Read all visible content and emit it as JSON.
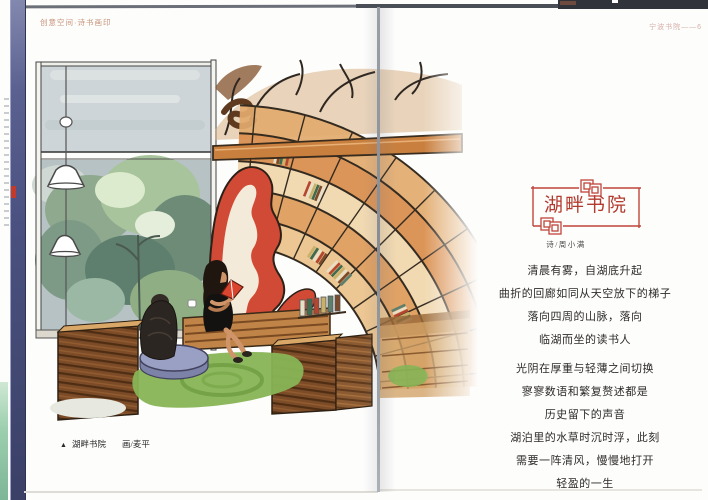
{
  "book": {
    "header_left": "创意空间·诗书画印",
    "header_right": "宁波书院——6"
  },
  "left_page": {
    "caption": {
      "marker": "▲",
      "title": "湖畔书院",
      "credit": "画/麦平"
    }
  },
  "right_page": {
    "title": "湖畔书院",
    "byline": "诗/周小满",
    "poem": {
      "stanza_1": [
        "清晨有雾，自湖底升起",
        "曲折的回廊如同从天空放下的梯子",
        "落向四周的山脉，落向",
        "临湖而坐的读书人"
      ],
      "stanza_2": [
        "光阴在厚重与轻薄之间切换",
        "寥寥数语和繁复赘述都是",
        "历史留下的声音",
        "湖泊里的水草时沉时浮，此刻",
        "需要一阵清风，慢慢地打开",
        "轻盈的一生"
      ]
    }
  },
  "colors": {
    "title_red": "#b23a2e",
    "frame_red": "#c0453a",
    "sculpture_red": "#d14a36",
    "shelf_wood": "#dd9a58",
    "bench_wood": "#7c4c28",
    "rug_green": "#88b455",
    "poem_ink": "#2e2b28",
    "cover_edge_blue": "#4a5180"
  }
}
